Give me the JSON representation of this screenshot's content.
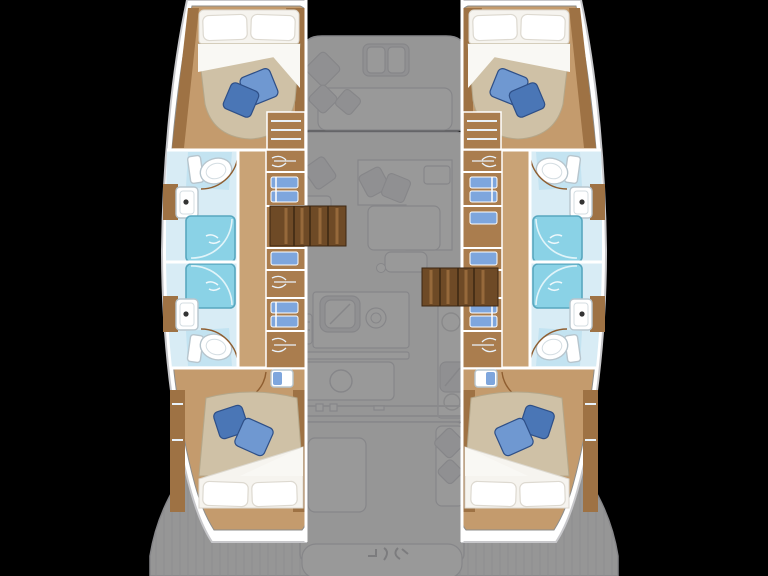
{
  "title": "catamaran-yacht-floor-plan",
  "palette": {
    "bg": "#000000",
    "hullFill": "#ffffff",
    "hullStroke": "#c7c7ca",
    "deckFill": "#fafafb",
    "deckStroke": "#e2e2e6",
    "furnFill": "#f1f1f4",
    "furnStroke": "#e0e0e4",
    "hatchLine": "#ededf0",
    "floorWood": "#c49b6d",
    "corridorWood": "#c9a376",
    "storageWood": "#aa7d4e",
    "trimWood": "#9e7244",
    "darkWood": "#6e4a26",
    "stairTread": "#96693b",
    "cabinStroke": "#8d8d8b",
    "bedSheet": "#f6f4ef",
    "sheetStroke": "#ddd9d0",
    "duvet": "#cfc1a6",
    "duvetStroke": "#b4a78a",
    "pillowBlue1": "#6f98d1",
    "pillowBlue2": "#4a76b6",
    "pillowStroke": "#2e4f87",
    "bathFloor": "#d8ecf5",
    "bathPad": "#c3e3f1",
    "fixtureStroke": "#b7c5cd",
    "shower": "#8ad2e6",
    "showerStroke": "#58a7bf",
    "linen": "#7ea6dd",
    "hangerLine": "#e9f2fa",
    "doorArc": "#8f5e30",
    "faucet": "#333333"
  },
  "vessel": {
    "type": "catamaran",
    "orientation": "bow-up",
    "hulls": [
      {
        "side": "port",
        "rooms": [
          "forward-cabin",
          "forward-bathroom",
          "aft-bathroom",
          "aft-cabin"
        ],
        "features": [
          "double-bed",
          "white-pillows",
          "blue-accent-pillows",
          "toilet",
          "washbasin",
          "shower",
          "shower",
          "washbasin",
          "toilet",
          "storage-lockers",
          "hanging-lockers",
          "companionway-stairs",
          "double-bed"
        ]
      },
      {
        "side": "starboard",
        "rooms": [
          "forward-cabin",
          "forward-bathroom",
          "aft-bathroom",
          "aft-cabin"
        ],
        "features": [
          "double-bed",
          "white-pillows",
          "blue-accent-pillows",
          "toilet",
          "washbasin",
          "shower",
          "shower",
          "washbasin",
          "toilet",
          "storage-lockers",
          "hanging-lockers",
          "companionway-stairs",
          "double-bed"
        ]
      }
    ],
    "center_deck": {
      "style": "faded",
      "zones": [
        "foredeck-lounge",
        "deck-hatch",
        "salon-sofa",
        "chart-seat",
        "salon-table",
        "galley-sink",
        "galley-stove",
        "galley-island",
        "aft-cockpit-table",
        "aft-cockpit-seat",
        "transom-bench",
        "swim-platforms"
      ]
    }
  }
}
